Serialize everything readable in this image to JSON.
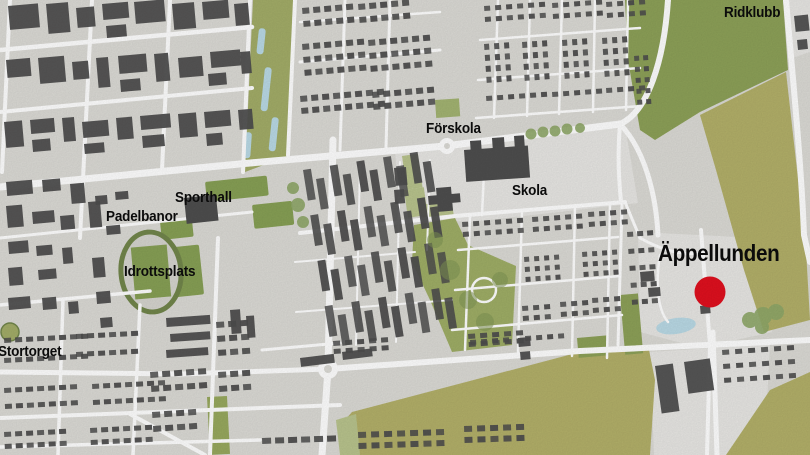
{
  "map": {
    "labels": {
      "stortorget": "Stortorget",
      "padelbanor": "Padelbanor",
      "sporthall": "Sporthall",
      "idrottsplats": "Idrottsplats",
      "forskola": "Förskola",
      "skola": "Skola",
      "ridklubb": "Ridklubb",
      "appellunden": "Äppellunden"
    },
    "marker": {
      "place": "Äppellunden",
      "color": "#e0101e"
    },
    "colors": {
      "road": "#ffffff",
      "block": "#dcdbd6",
      "plaza": "#e8e7e4",
      "building": "#4e4e4e",
      "park_mid": "#a3ad68",
      "park_light": "#b9c48d",
      "field_yellow": "#b3b069",
      "field_green": "#8da158",
      "sports_green": "#87a055",
      "track_ring": "#72864b",
      "water": "#badae6",
      "marker_red": "#e0101e"
    }
  }
}
